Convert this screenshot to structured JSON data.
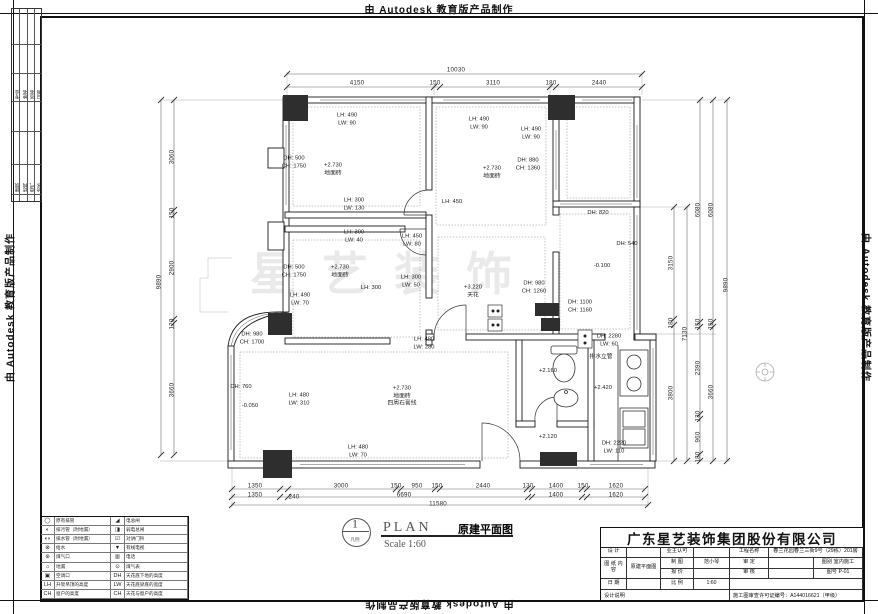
{
  "banner": {
    "text": "由 Autodesk 教育版产品制作"
  },
  "watermark": "星艺装饰",
  "side_strip": {
    "group1": [
      "专业",
      "姓名",
      "签名",
      "日期"
    ],
    "group2": [
      "建筑",
      "结构",
      "电气",
      "给水"
    ]
  },
  "plan_title": {
    "bubble_number": "1",
    "bubble_sub": "凡例",
    "plan_word": "PLAN",
    "name": "原建平面图",
    "scale": "Scale 1:60"
  },
  "legend": {
    "rows": [
      {
        "s1": "◯",
        "l1": "原有排管",
        "s2": "◢",
        "l2": "电总闸"
      },
      {
        "s1": "◐",
        "l1": "排污管（附地漏）",
        "s2": "◨",
        "l2": "弱电总闸"
      },
      {
        "s1": "◖◗",
        "l1": "排水管（附地漏）",
        "s2": "☑",
        "l2": "对讲门铃"
      },
      {
        "s1": "⊗",
        "l1": "给水",
        "s2": "▼",
        "l2": "有线电视"
      },
      {
        "s1": "⊛",
        "l1": "煤气口",
        "s2": "▥",
        "l2": "电话"
      },
      {
        "s1": "⌂",
        "l1": "地漏",
        "s2": "⊙",
        "l2": "煤气表"
      },
      {
        "s1": "▣",
        "l1": "空调口",
        "s2": "DH",
        "l2": "天花底下地的高度"
      },
      {
        "s1": "LH",
        "l1": "升架吊顶的高度",
        "s2": "LW",
        "l2": "天花底梁底的宽度"
      },
      {
        "s1": "CH",
        "l1": "窗户的高度",
        "s2": "CH",
        "l2": "天花与窗户的高度"
      }
    ]
  },
  "title_block": {
    "company": "广东星艺装饰集团股份有限公司",
    "design_label": "设 计",
    "draft_label": "制 图",
    "draft_value": "范小琴",
    "quote_label": "报 价",
    "date_label": "日 期",
    "owner_label": "业主认可",
    "approve_label": "审 定",
    "review_label": "审 核",
    "scale_label": "比 例",
    "scale_value": "1:60",
    "project_label": "工程名称",
    "project_value": "春兰花园春兰三街9号（29栋）201房",
    "sheet_label": "图 纸\n内 容",
    "sheet_value": "原建平面图",
    "cat_label": "图别",
    "cat_value": "室内施工",
    "no_label": "图号",
    "no_value": "P-01",
    "notes_label": "设计说明",
    "permit": "施工图审查许可证编号：A144016621（甲级）"
  },
  "plan": {
    "annotations": [
      {
        "t": "10030",
        "x": 456,
        "y": 70,
        "c": "dim"
      },
      {
        "t": "4150",
        "x": 357,
        "y": 83,
        "c": "dim"
      },
      {
        "t": "150",
        "x": 435,
        "y": 83,
        "c": "dim"
      },
      {
        "t": "3110",
        "x": 493,
        "y": 83,
        "c": "dim"
      },
      {
        "t": "180",
        "x": 551,
        "y": 83,
        "c": "dim"
      },
      {
        "t": "2440",
        "x": 599,
        "y": 83,
        "c": "dim"
      },
      {
        "t": "1350",
        "x": 255,
        "y": 486,
        "c": "dim"
      },
      {
        "t": "3000",
        "x": 341,
        "y": 486,
        "c": "dim"
      },
      {
        "t": "150",
        "x": 396,
        "y": 486,
        "c": "dim"
      },
      {
        "t": "950",
        "x": 417,
        "y": 486,
        "c": "dim"
      },
      {
        "t": "150",
        "x": 437,
        "y": 486,
        "c": "dim"
      },
      {
        "t": "2440",
        "x": 483,
        "y": 486,
        "c": "dim"
      },
      {
        "t": "130",
        "x": 528,
        "y": 486,
        "c": "dim"
      },
      {
        "t": "1400",
        "x": 556,
        "y": 486,
        "c": "dim"
      },
      {
        "t": "150",
        "x": 583,
        "y": 486,
        "c": "dim"
      },
      {
        "t": "1620",
        "x": 616,
        "y": 486,
        "c": "dim"
      },
      {
        "t": "1350",
        "x": 255,
        "y": 495,
        "c": "dim"
      },
      {
        "t": "240",
        "x": 294,
        "y": 497,
        "c": "dim"
      },
      {
        "t": "6690",
        "x": 404,
        "y": 495,
        "c": "dim"
      },
      {
        "t": "1400",
        "x": 556,
        "y": 495,
        "c": "dim"
      },
      {
        "t": "1620",
        "x": 616,
        "y": 495,
        "c": "dim"
      },
      {
        "t": "11580",
        "x": 438,
        "y": 504,
        "c": "dim"
      },
      {
        "t": "9890",
        "x": 159,
        "y": 282,
        "r": -90,
        "c": "dim"
      },
      {
        "t": "3060",
        "x": 172,
        "y": 157,
        "r": -90,
        "c": "dim"
      },
      {
        "t": "150",
        "x": 172,
        "y": 213,
        "r": -90,
        "c": "dim"
      },
      {
        "t": "2900",
        "x": 172,
        "y": 268,
        "r": -90,
        "c": "dim"
      },
      {
        "t": "120",
        "x": 172,
        "y": 324,
        "r": -90,
        "c": "dim"
      },
      {
        "t": "3660",
        "x": 172,
        "y": 390,
        "r": -90,
        "c": "dim"
      },
      {
        "t": "3150",
        "x": 671,
        "y": 263,
        "r": -90,
        "c": "dim"
      },
      {
        "t": "180",
        "x": 671,
        "y": 323,
        "r": -90,
        "c": "dim"
      },
      {
        "t": "3800",
        "x": 671,
        "y": 393,
        "r": -90,
        "c": "dim"
      },
      {
        "t": "7130",
        "x": 685,
        "y": 334,
        "r": -90,
        "c": "dim"
      },
      {
        "t": "6080",
        "x": 698,
        "y": 210,
        "r": -90,
        "c": "dim"
      },
      {
        "t": "150",
        "x": 698,
        "y": 324,
        "r": -90,
        "c": "dim"
      },
      {
        "t": "2390",
        "x": 698,
        "y": 368,
        "r": -90,
        "c": "dim"
      },
      {
        "t": "130",
        "x": 698,
        "y": 416,
        "r": -90,
        "c": "dim"
      },
      {
        "t": "960",
        "x": 698,
        "y": 437,
        "r": -90,
        "c": "dim"
      },
      {
        "t": "180",
        "x": 698,
        "y": 457,
        "r": -90,
        "c": "dim"
      },
      {
        "t": "6080",
        "x": 711,
        "y": 210,
        "r": -90,
        "c": "dim"
      },
      {
        "t": "150",
        "x": 711,
        "y": 324,
        "r": -90,
        "c": "dim"
      },
      {
        "t": "3660",
        "x": 711,
        "y": 392,
        "r": -90,
        "c": "dim"
      },
      {
        "t": "9890",
        "x": 726,
        "y": 285,
        "r": -90,
        "c": "dim"
      },
      {
        "t": "LH: 490\nLW: 90",
        "x": 347,
        "y": 120
      },
      {
        "t": "DH: 500\nCH: 1750",
        "x": 294,
        "y": 163
      },
      {
        "t": "+2.730\n地面砖",
        "x": 333,
        "y": 170
      },
      {
        "t": "LH: 490\nLW: 70",
        "x": 300,
        "y": 300
      },
      {
        "t": "LH: 300\nLW: 130",
        "x": 354,
        "y": 205
      },
      {
        "t": "LH: 300\nLW: 40",
        "x": 354,
        "y": 237
      },
      {
        "t": "LH: 450\nLW: 80",
        "x": 412,
        "y": 241
      },
      {
        "t": "LH: 450",
        "x": 452,
        "y": 203
      },
      {
        "t": "DH: 500\nCH: 1750",
        "x": 294,
        "y": 272
      },
      {
        "t": "+2.730\n地面砖",
        "x": 340,
        "y": 272
      },
      {
        "t": "LH: 300\nLW: 50",
        "x": 411,
        "y": 282
      },
      {
        "t": "LH: 300",
        "x": 371,
        "y": 289
      },
      {
        "t": "LH: 490\nLW: 90",
        "x": 479,
        "y": 124
      },
      {
        "t": "LH: 490\nLW: 90",
        "x": 531,
        "y": 134
      },
      {
        "t": "+2.730\n地面砖",
        "x": 492,
        "y": 173
      },
      {
        "t": "DH: 880\nCH: 1360",
        "x": 528,
        "y": 165
      },
      {
        "t": "DH: 820",
        "x": 598,
        "y": 214
      },
      {
        "t": "DH: 540",
        "x": 627,
        "y": 245
      },
      {
        "t": "-0.100",
        "x": 602,
        "y": 267
      },
      {
        "t": "DH: 980\nCH: 1260",
        "x": 534,
        "y": 288
      },
      {
        "t": "DH: 1100\nCH: 1160",
        "x": 580,
        "y": 307
      },
      {
        "t": "+3.220\n天花",
        "x": 473,
        "y": 292
      },
      {
        "t": "LH: 480\nLW: 280",
        "x": 424,
        "y": 344
      },
      {
        "t": "DH: 2280\nLW: 60",
        "x": 609,
        "y": 341
      },
      {
        "t": "排水立管",
        "x": 601,
        "y": 358
      },
      {
        "t": "+2.160",
        "x": 548,
        "y": 372
      },
      {
        "t": "+2.420",
        "x": 603,
        "y": 389
      },
      {
        "t": "+2.120",
        "x": 548,
        "y": 438
      },
      {
        "t": "DH: 2220\nLW: 110",
        "x": 614,
        "y": 448
      },
      {
        "t": "DH: 980\nCH: 1700",
        "x": 252,
        "y": 339
      },
      {
        "t": "DH: 760",
        "x": 241,
        "y": 388
      },
      {
        "t": "-0.050",
        "x": 250,
        "y": 407
      },
      {
        "t": "LH: 480\nLW: 310",
        "x": 299,
        "y": 400
      },
      {
        "t": "+2.730\n地面砖\n四周石膏线",
        "x": 402,
        "y": 397
      },
      {
        "t": "LH: 480\nLW: 70",
        "x": 358,
        "y": 452
      }
    ]
  }
}
